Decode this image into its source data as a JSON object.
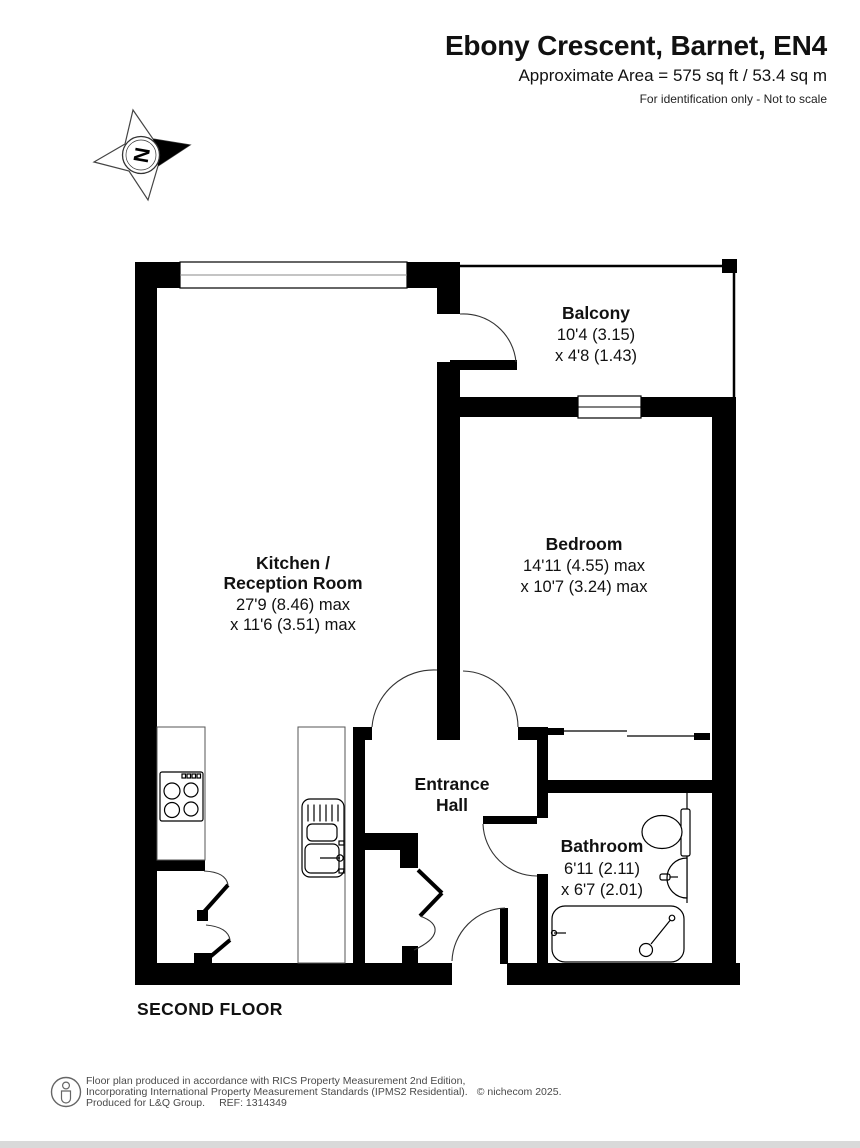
{
  "header": {
    "title": "Ebony Crescent, Barnet, EN4",
    "subtitle": "Approximate Area = 575 sq ft / 53.4 sq m",
    "note": "For identification only - Not to scale"
  },
  "compass": {
    "north_label": "N"
  },
  "rooms": {
    "balcony": {
      "name": "Balcony",
      "dim_line1": "10'4 (3.15)",
      "dim_line2": "x 4'8 (1.43)"
    },
    "kitchen_reception": {
      "name_line1": "Kitchen /",
      "name_line2": "Reception Room",
      "dim_line1": "27'9 (8.46) max",
      "dim_line2": "x 11'6 (3.51) max"
    },
    "bedroom": {
      "name": "Bedroom",
      "dim_line1": "14'11 (4.55) max",
      "dim_line2": "x 10'7 (3.24) max"
    },
    "entrance_hall": {
      "name_line1": "Entrance",
      "name_line2": "Hall"
    },
    "bathroom": {
      "name": "Bathroom",
      "dim_line1": "6'11 (2.11)",
      "dim_line2": "x 6'7 (2.01)"
    }
  },
  "floor_label": "SECOND FLOOR",
  "footer": {
    "line1": "Floor plan produced in accordance with RICS Property Measurement 2nd Edition,",
    "line2": "Incorporating International Property Measurement Standards (IPMS2 Residential).",
    "copyright": "© nichecom 2025.",
    "line3": "Produced for L&Q Group.",
    "ref": "REF: 1314349",
    "icon": "person-icon"
  },
  "colors": {
    "wall": "#000000",
    "text": "#111111",
    "footer_text": "#4a4a4a"
  }
}
